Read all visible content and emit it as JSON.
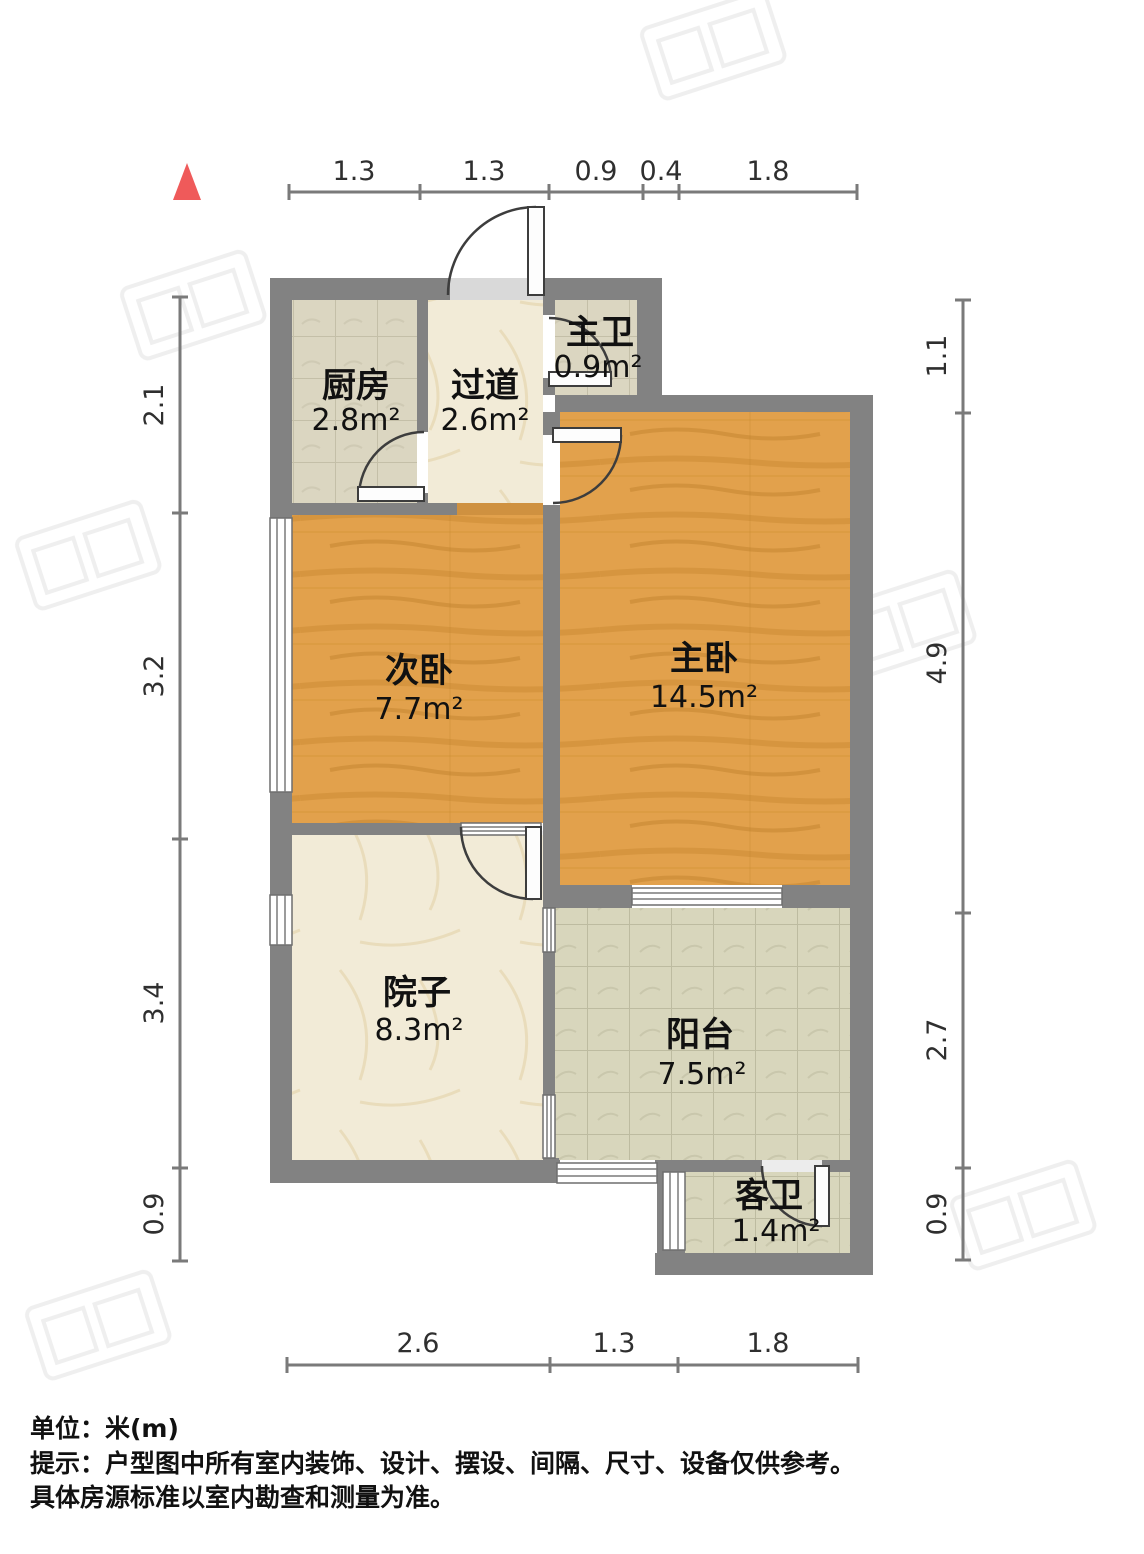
{
  "notes": {
    "unit": "单位：米(m)",
    "tip1": "提示：户型图中所有室内装饰、设计、摆设、间隔、尺寸、设备仅供参考。",
    "tip2": "具体房源标准以室内勘查和测量为准。"
  },
  "north_arrow": {
    "icon": "north-arrow",
    "color": "#ef5a5a"
  },
  "rooms": [
    {
      "id": "kitchen",
      "name": "厨房",
      "area": "2.8m²"
    },
    {
      "id": "hallway",
      "name": "过道",
      "area": "2.6m²"
    },
    {
      "id": "master-bathroom",
      "name": "主卫",
      "area": "0.9m²"
    },
    {
      "id": "second-bedroom",
      "name": "次卧",
      "area": "7.7m²"
    },
    {
      "id": "master-bedroom",
      "name": "主卧",
      "area": "14.5m²"
    },
    {
      "id": "courtyard",
      "name": "院子",
      "area": "8.3m²"
    },
    {
      "id": "balcony",
      "name": "阳台",
      "area": "7.5m²"
    },
    {
      "id": "guest-bathroom",
      "name": "客卫",
      "area": "1.4m²"
    }
  ],
  "dimensions": {
    "unit": "m",
    "top": [
      "1.3",
      "1.3",
      "0.9",
      "0.4",
      "1.8"
    ],
    "left": [
      "2.1",
      "3.2",
      "3.4",
      "0.9"
    ],
    "right": [
      "1.1",
      "4.9",
      "2.7",
      "0.9"
    ],
    "bottom": [
      "2.6",
      "1.3",
      "1.8"
    ]
  },
  "colors": {
    "wall": "#828282",
    "wood_floor": "#e2a14c",
    "tile_beige": "#dbd6c1",
    "marble_cream": "#f2ebd7",
    "tile_green": "#d8d6bc",
    "dim_line": "#7a7a7a",
    "north_arrow": "#ef5a5a",
    "text": "#111111"
  }
}
